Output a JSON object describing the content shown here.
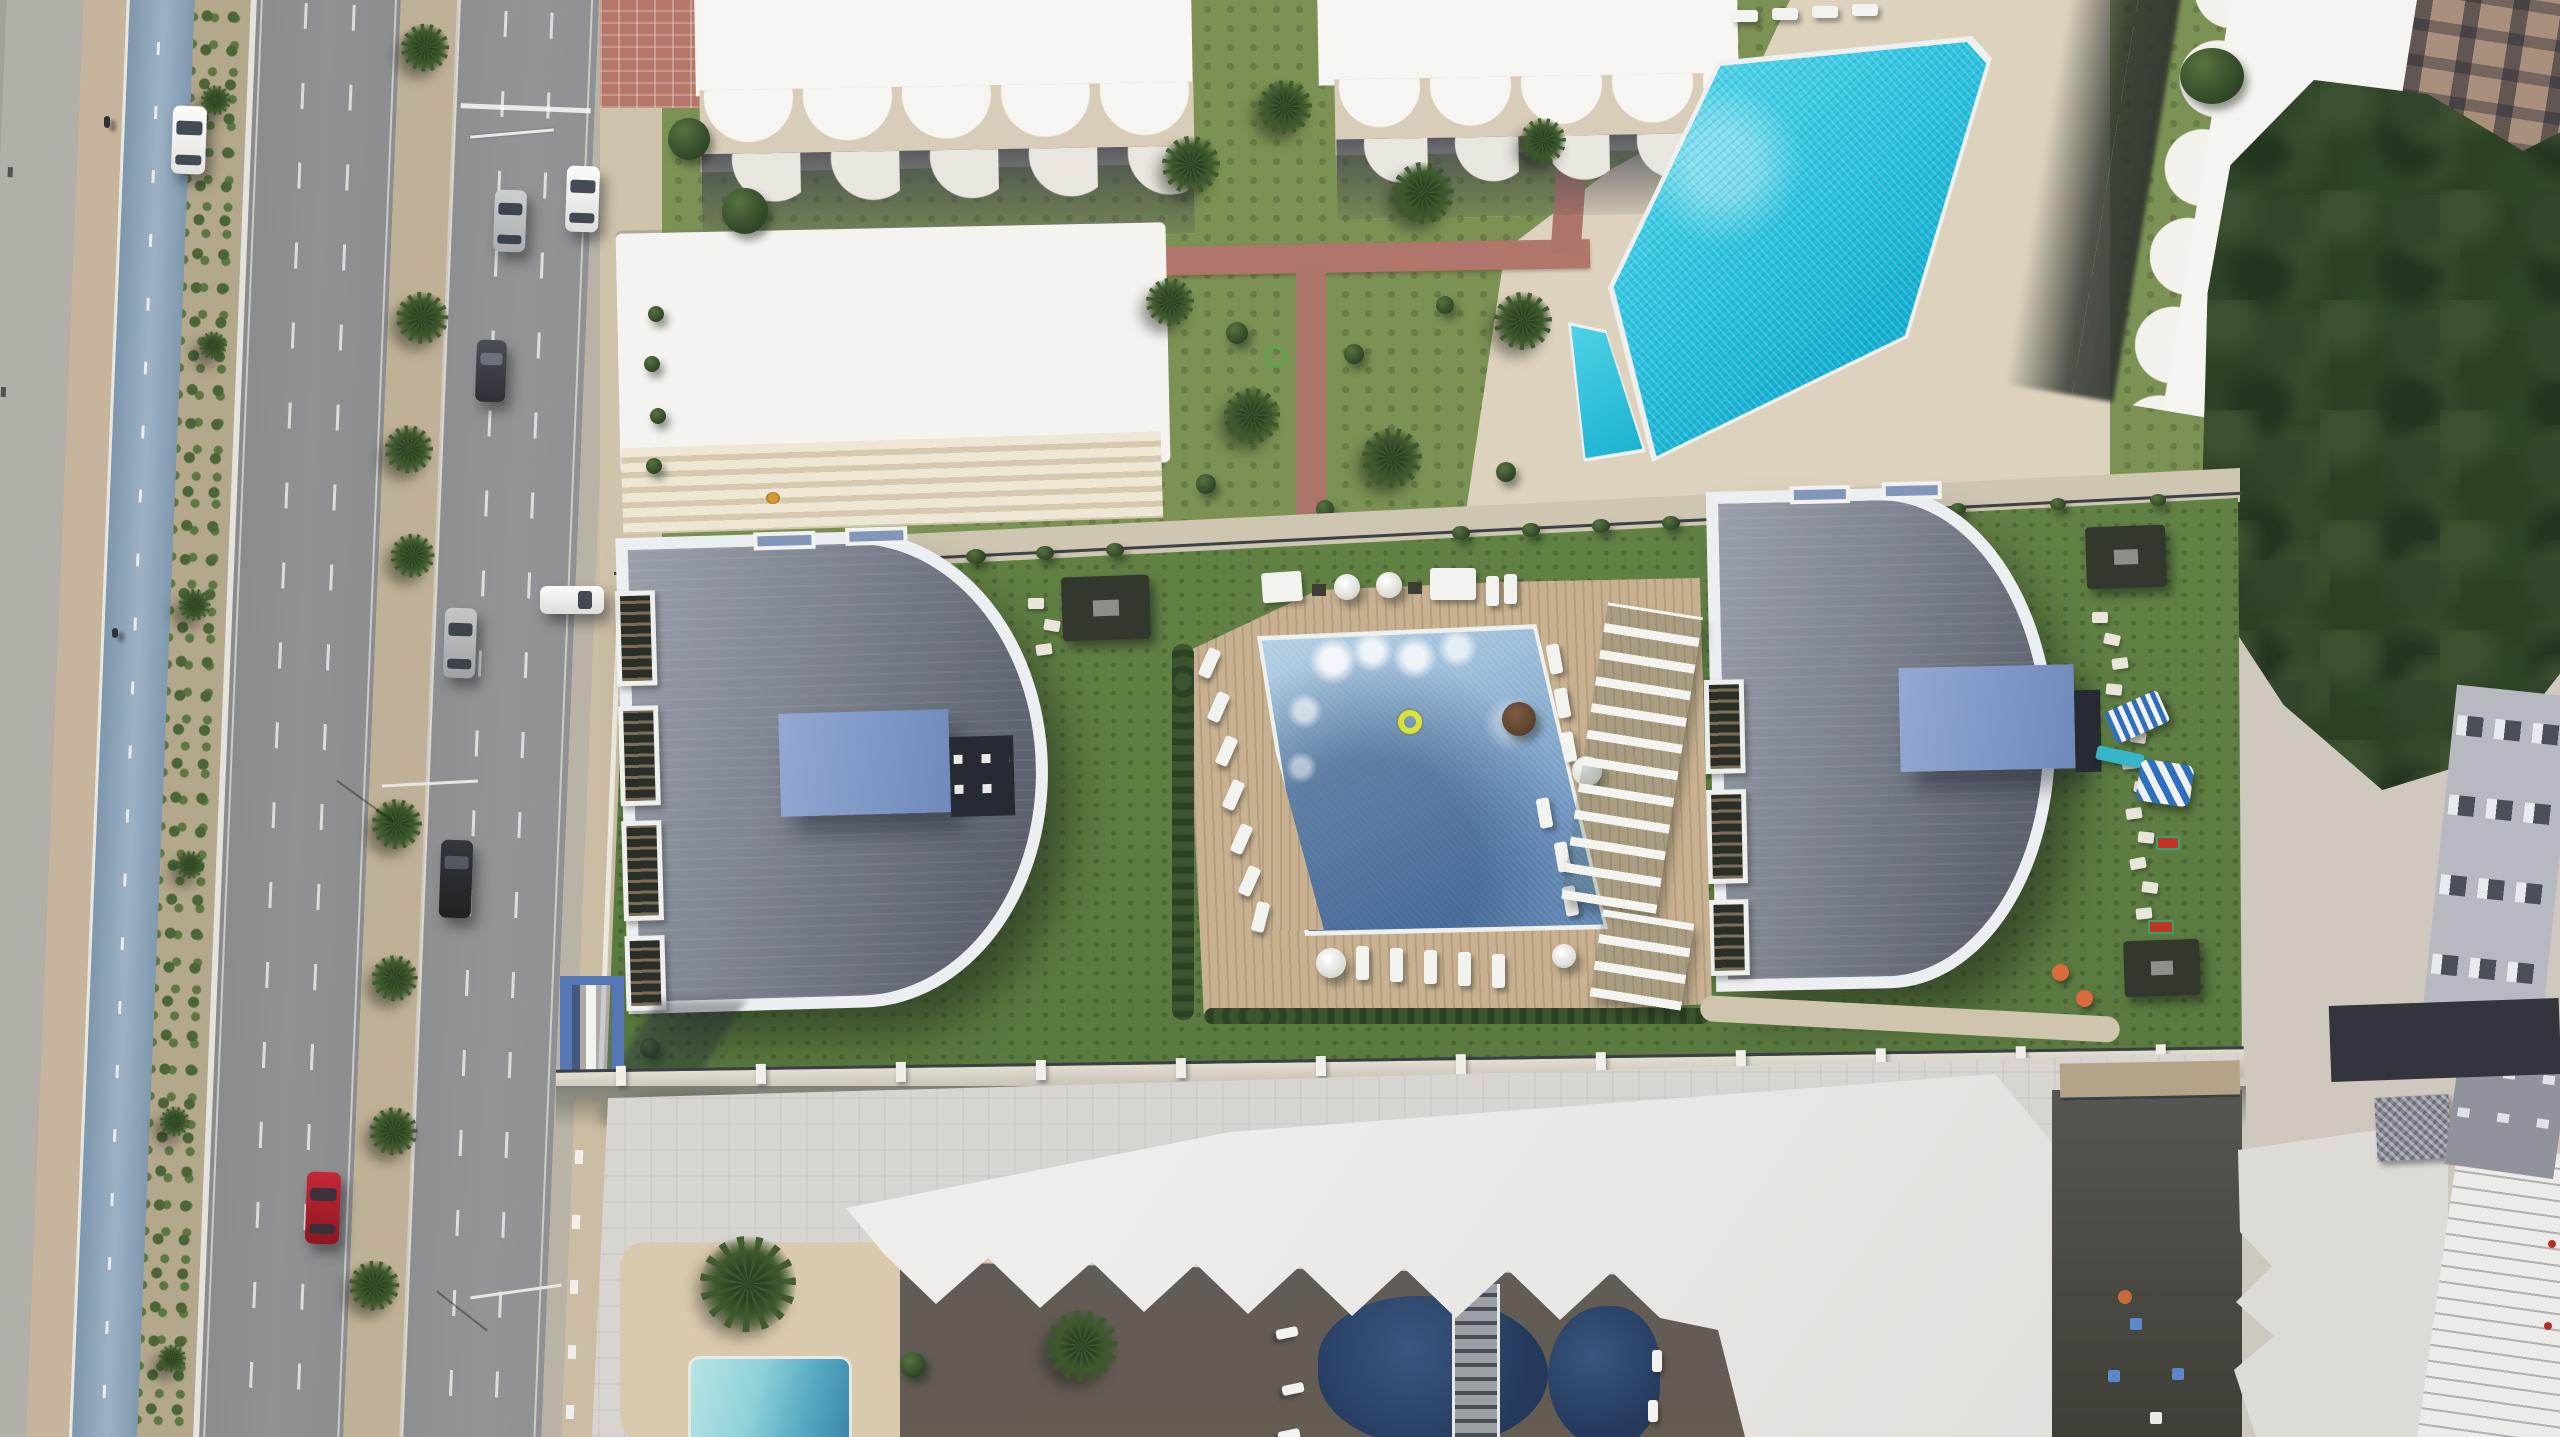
{
  "scene": {
    "type": "aerial-architectural-render",
    "title": "Top-down aerial render of a seafront residential complex between a coastal boulevard and neighbouring resorts",
    "orientation": "top-down drone view",
    "time_of_day": "midday, hard sun from upper right"
  },
  "palette": {
    "asphalt": "#8f9092",
    "bike_lane_blue": "#8ba2b7",
    "resort_lawn": "#7c9154",
    "complex_lawn": "#5e7c41",
    "resort_pool_turquoise": "#1fb9d8",
    "central_pool_mosaic": "#7da4c9",
    "curved_roof_grey": "#70767f",
    "roof_terrace_blue": "#8aa0cc",
    "timber_deck": "#c9b294",
    "stone_deck": "#ddd2bd",
    "building_white": "#f3f2ee",
    "plaza_grey": "#d8d5d0",
    "tree_canopy": "#2e4226",
    "shaded_pool": "#2c4260",
    "gate_blue": "#5677b5",
    "car_red": "#b01f2e"
  },
  "regions": {
    "boulevard": "Multi-lane coastal boulevard with palm median",
    "bike_lane": "Blue seaside bicycle path",
    "median": "Planted median with palms",
    "sidewalk_east": "Sand-coloured sidewalk along the complex",
    "resort_north": "Neighbouring resort with scalloped balconies",
    "building_a": "White resort block with wave-shaped balconies",
    "building_b": "White resort block with stepped terrace",
    "building_c": "White resort block with wave-shaped balconies",
    "building_d": "White resort tower, rotated, scalloped east wing",
    "building_e": "Tan apartment building with window grid",
    "resort_garden": "Mature resort garden with brick walkways",
    "resort_pool": "Free-form turquoise resort swimming pool",
    "kids_pool": "Small children's wading pool",
    "pool_deck_resort": "Beige pool terrace of the resort",
    "tree_grove": "Dense dark-green tree grove",
    "complex": "New residential parcel with two curved-roof blocks",
    "complex_lawn": "Landscaped lawn of the residence",
    "building_west": "West block, curved grey standing-seam roof",
    "building_east": "East block, curved grey standing-seam roof",
    "roof_terrace_west": "Blue glazed roof terrace of the west block",
    "roof_terrace_east": "Blue glazed roof terrace of the east block",
    "central_pool": "Shared mosaic pool with yellow swim ring",
    "timber_deck": "Timber sun deck with white loungers and parasols",
    "pergola_west": "Timber dining pergola",
    "pergola_east": "Timber dining pergola",
    "pergola_south": "Garden pergola",
    "pergola_shades": "White slatted shade pergolas",
    "playground": "Children's playground with striped slide and tent",
    "entrance_gate": "Blue entrance portal on the boulevard",
    "boundary_wall": "South boundary wall with white posts",
    "plaza": "Paved forecourt of the southern hotel",
    "south_resort": "Southern hotel with sawtooth roof edge",
    "south_pools": "Shaded figure-eight pools with ladder bridge",
    "pool_bridge": "Footbridge with ladder rungs between pools",
    "south_kids_pool": "Turquoise hotel pool at bottom edge",
    "se_roof": "South-east white roof with vent grille",
    "east_facades": "Neighbouring facades on the east edge",
    "cars": "Cars driving and parked along the boulevard"
  },
  "objects": {
    "cars": [
      {
        "color": "white",
        "state": "driving north lane"
      },
      {
        "color": "white",
        "state": "parked at curb"
      },
      {
        "color": "silver",
        "state": "parked at curb"
      },
      {
        "color": "dark grey",
        "state": "parked at curb"
      },
      {
        "color": "silver",
        "state": "driving"
      },
      {
        "color": "black",
        "state": "driving"
      },
      {
        "color": "red",
        "state": "driving south"
      },
      {
        "color": "white",
        "state": "parked at residence entrance"
      }
    ],
    "pool_float": {
      "color": "yellow",
      "shape": "ring"
    },
    "bean_bags": {
      "color": "orange",
      "count": 3
    }
  }
}
